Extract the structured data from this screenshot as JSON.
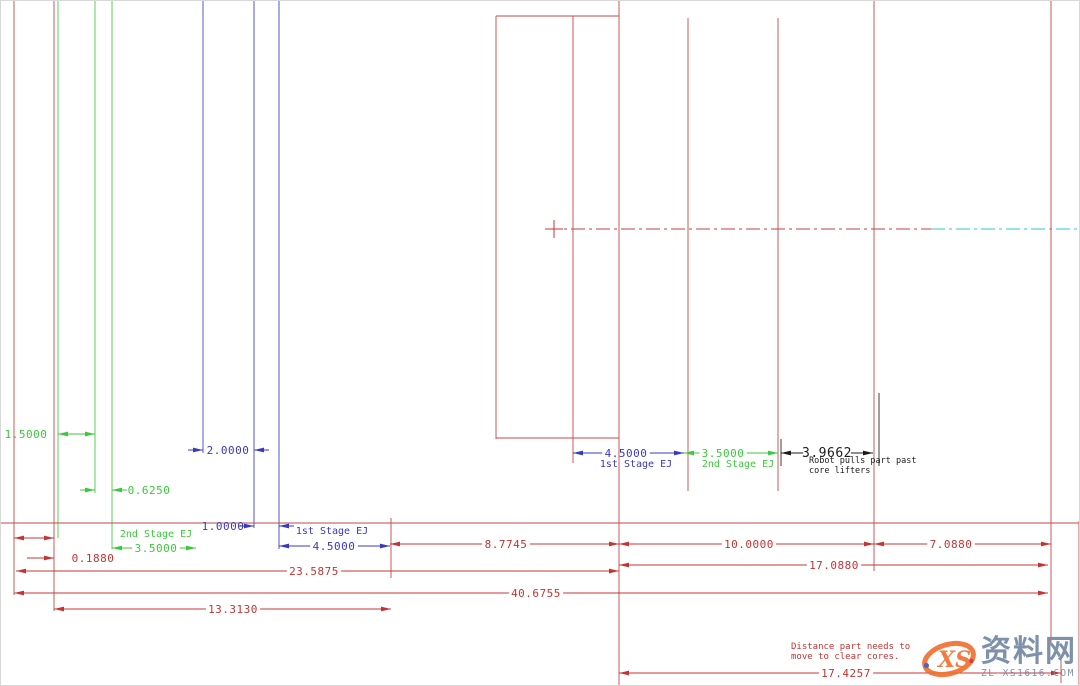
{
  "palette": {
    "red": "#c43434",
    "blue": "#3838c0",
    "green": "#3cc83c",
    "black": "#1c1c1c",
    "cyan": "#2cc8c8",
    "construction_red": "#c04040",
    "watermark_orange": "#f07030",
    "watermark_gray_blue": "#7488a6",
    "background": "#ffffff"
  },
  "stages": [
    {
      "id": "part-molded-position",
      "color": "red",
      "x": 557,
      "cap": false
    },
    {
      "id": "part-first-stage-eject",
      "color": "blue",
      "x": 671,
      "cap": false
    },
    {
      "id": "part-second-stage-eject",
      "color": "green",
      "x": 760,
      "cap": false
    },
    {
      "id": "part-robot-pull-position",
      "color": "black",
      "x": 861,
      "cap": true
    }
  ],
  "construction": {
    "vlines": [
      {
        "x": 13,
        "y1": 0,
        "y2": 594,
        "c": "red"
      },
      {
        "x": 53,
        "y1": 0,
        "y2": 610,
        "c": "red"
      },
      {
        "x": 57,
        "y1": 0,
        "y2": 537,
        "c": "green"
      },
      {
        "x": 94,
        "y1": 0,
        "y2": 492,
        "c": "green"
      },
      {
        "x": 111,
        "y1": 0,
        "y2": 548,
        "c": "green"
      },
      {
        "x": 202,
        "y1": 0,
        "y2": 452,
        "c": "blue"
      },
      {
        "x": 253,
        "y1": 0,
        "y2": 527,
        "c": "blue"
      },
      {
        "x": 278,
        "y1": 0,
        "y2": 548,
        "c": "blue"
      },
      {
        "x": 390,
        "y1": 517,
        "y2": 577,
        "c": "red"
      },
      {
        "x": 495,
        "y1": 15,
        "y2": 438,
        "c": "red"
      },
      {
        "x": 572,
        "y1": 15,
        "y2": 462,
        "c": "red"
      },
      {
        "x": 618,
        "y1": 0,
        "y2": 686,
        "c": "red"
      },
      {
        "x": 687,
        "y1": 17,
        "y2": 490,
        "c": "red"
      },
      {
        "x": 777,
        "y1": 17,
        "y2": 490,
        "c": "red"
      },
      {
        "x": 873,
        "y1": 0,
        "y2": 570,
        "c": "red"
      },
      {
        "x": 1050,
        "y1": 0,
        "y2": 643,
        "c": "red"
      },
      {
        "x": 1060,
        "y1": 658,
        "y2": 682,
        "c": "red"
      },
      {
        "x": 1078,
        "y1": 520,
        "y2": 686,
        "c": "red"
      },
      {
        "x": 780,
        "y1": 438,
        "y2": 465,
        "c": "black"
      },
      {
        "x": 878,
        "y1": 392,
        "y2": 465,
        "c": "black"
      }
    ],
    "hlines": [
      {
        "y": 15,
        "x1": 495,
        "x2": 618,
        "c": "red"
      },
      {
        "y": 437,
        "x1": 495,
        "x2": 618,
        "c": "red"
      },
      {
        "y": 522,
        "x1": 0,
        "x2": 1078,
        "c": "red"
      }
    ],
    "centerlines": [
      {
        "y": 228,
        "x1": 545,
        "x2": 930,
        "c": "red"
      },
      {
        "y": 228,
        "x1": 930,
        "x2": 1080,
        "c": "cyan"
      }
    ],
    "cross": {
      "x": 553,
      "y": 228,
      "r": 9
    }
  },
  "dimensions": [
    {
      "id": "dim-1-5000",
      "c": "green",
      "y": 433,
      "x1": 57,
      "x2": 94,
      "style": "in",
      "gap": false,
      "text": "1.5000",
      "tx": 25,
      "ty": 437
    },
    {
      "id": "dim-0-6250",
      "c": "green",
      "y": 489,
      "x1": 94,
      "x2": 111,
      "style": "out",
      "text": "0.6250",
      "tx": 148,
      "ty": 493
    },
    {
      "id": "dim-2-0000",
      "c": "blue",
      "y": 449,
      "x1": 202,
      "x2": 253,
      "style": "out",
      "text": "2.0000",
      "tx": 227,
      "ty": 453
    },
    {
      "id": "dim-1-0000",
      "c": "blue",
      "y": 525,
      "x1": 253,
      "x2": 278,
      "style": "out",
      "text": "1.0000",
      "tx": 222,
      "ty": 529
    },
    {
      "id": "dim-2nd-stage-ej-3-5000",
      "c": "green",
      "y": 547,
      "x1": 111,
      "x2": 195,
      "style": "in",
      "gap": true,
      "text": "3.5000",
      "tx": 155,
      "label": "2nd Stage EJ",
      "lx": 155,
      "ly": 536
    },
    {
      "id": "dim-1st-stage-ej-4-5000",
      "c": "blue",
      "y": 545,
      "x1": 278,
      "x2": 389,
      "style": "in",
      "gap": true,
      "text": "4.5000",
      "tx": 333,
      "label": "1st Stage EJ",
      "lx": 331,
      "ly": 533
    },
    {
      "id": "dim-small-left",
      "c": "red",
      "y": 537,
      "x1": 13,
      "x2": 53,
      "style": "in",
      "gap": false,
      "text": "",
      "tx": 0
    },
    {
      "id": "dim-0-1880",
      "c": "red",
      "type": "leader",
      "y": 557,
      "x1": 26,
      "x2": 53,
      "text": "0.1880",
      "tx": 92,
      "ty": 561
    },
    {
      "id": "dim-8-7745",
      "c": "red",
      "y": 543,
      "x1": 389,
      "x2": 618,
      "style": "in",
      "gap": true,
      "text": "8.7745",
      "tx": 505
    },
    {
      "id": "dim-10-0000",
      "c": "red",
      "y": 543,
      "x1": 618,
      "x2": 873,
      "style": "in",
      "gap": true,
      "text": "10.0000",
      "tx": 748
    },
    {
      "id": "dim-7-0880",
      "c": "red",
      "y": 543,
      "x1": 873,
      "x2": 1050,
      "style": "in",
      "gap": true,
      "text": "7.0880",
      "tx": 950
    },
    {
      "id": "dim-23-5875",
      "c": "red",
      "y": 570,
      "x1": 15,
      "x2": 618,
      "style": "in",
      "gap": true,
      "text": "23.5875",
      "tx": 313
    },
    {
      "id": "dim-17-0880",
      "c": "red",
      "y": 564,
      "x1": 618,
      "x2": 1047,
      "style": "in",
      "gap": true,
      "text": "17.0880",
      "tx": 833
    },
    {
      "id": "dim-40-6755",
      "c": "red",
      "y": 592,
      "x1": 13,
      "x2": 1047,
      "style": "in",
      "gap": true,
      "text": "40.6755",
      "tx": 535
    },
    {
      "id": "dim-13-3130",
      "c": "red",
      "y": 608,
      "x1": 53,
      "x2": 390,
      "style": "in",
      "gap": true,
      "text": "13.3130",
      "tx": 232
    },
    {
      "id": "dim-17-4257",
      "c": "red",
      "y": 672,
      "x1": 618,
      "x2": 1060,
      "style": "in",
      "gap": true,
      "text": "17.4257",
      "tx": 845
    },
    {
      "id": "dim-mid-4-5000",
      "c": "blue",
      "y": 452,
      "x1": 572,
      "x2": 683,
      "style": "in",
      "gap": true,
      "text": "4.5000",
      "tx": 625,
      "label": "1st Stage EJ",
      "lx": 635,
      "ly": 466
    },
    {
      "id": "dim-mid-3-5000",
      "c": "green",
      "y": 452,
      "x1": 683,
      "x2": 777,
      "style": "in",
      "gap": true,
      "text": "3.5000",
      "tx": 722,
      "label": "2nd Stage EJ",
      "lx": 737,
      "ly": 466
    },
    {
      "id": "dim-3-9662",
      "c": "black",
      "y": 452,
      "x1": 780,
      "x2": 872,
      "style": "in",
      "gap": true,
      "text": "3.9662",
      "tx": 826,
      "fs": 13,
      "label2": [
        "Robot pulls part past",
        "core lifters"
      ],
      "lx": 808,
      "ly": 462
    }
  ],
  "notes": [
    {
      "id": "note-clear-cores",
      "c": "red",
      "x": 790,
      "y": 648,
      "size": 9,
      "lines": [
        "Distance part needs to",
        "move to clear cores."
      ]
    }
  ],
  "watermark": {
    "logo_text": "XS",
    "site_name": "资料网",
    "site_url": "ZL-XS1616.COM"
  }
}
